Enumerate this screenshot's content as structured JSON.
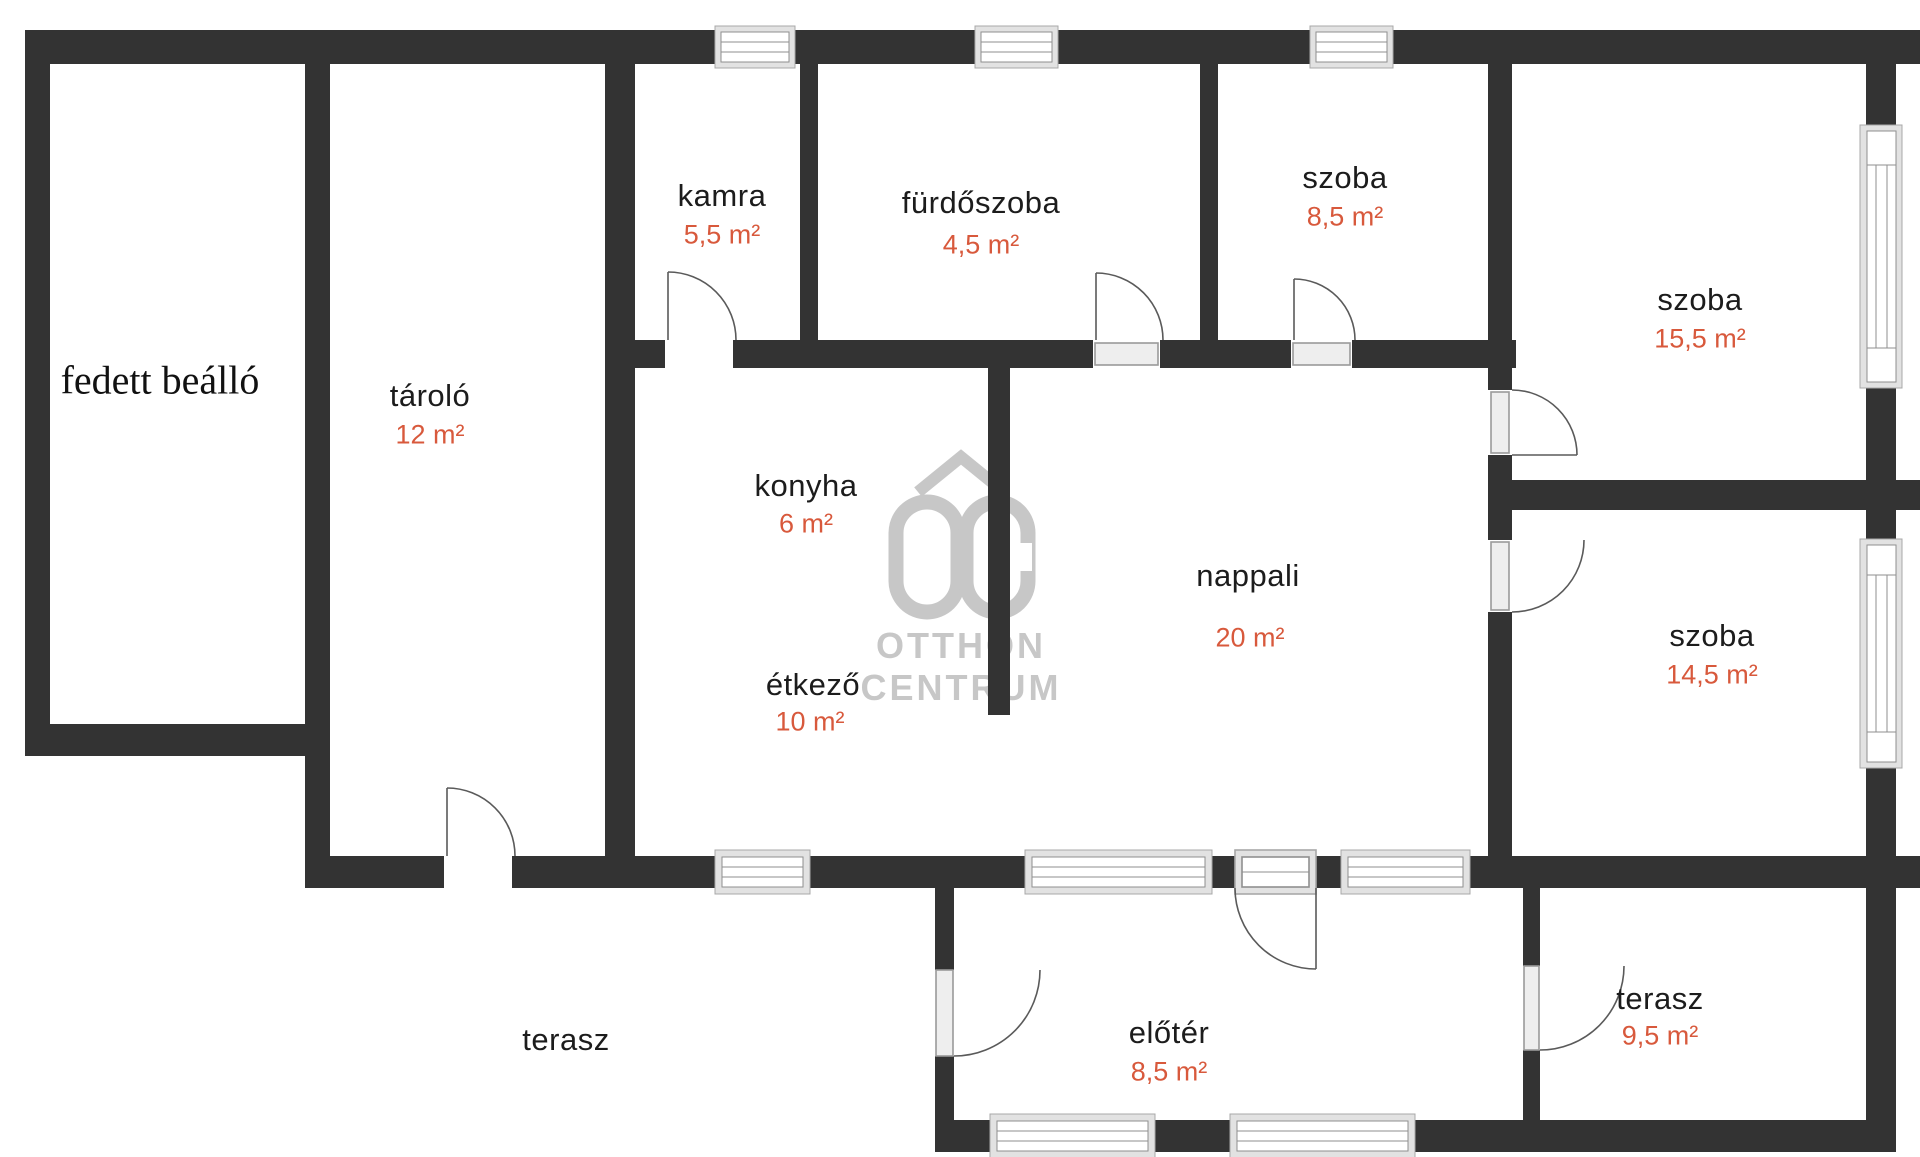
{
  "title": "floor-plan",
  "colors": {
    "wall": "#333333",
    "accent_area": "#d8593c",
    "room_text": "#1c1c1c",
    "watermark": "#c7c7c7",
    "window_frame": "#e2e2e2",
    "window_line": "#8f8f8f"
  },
  "watermark": {
    "monogram": "OC",
    "line1": "OTTHON",
    "line2": "CENTRUM"
  },
  "rooms": [
    {
      "id": "fedett-beallo",
      "name": "fedett beálló",
      "area": ""
    },
    {
      "id": "tarolo",
      "name": "tároló",
      "area": "12 m²"
    },
    {
      "id": "kamra",
      "name": "kamra",
      "area": "5,5 m²"
    },
    {
      "id": "furdoszoba",
      "name": "fürdőszoba",
      "area": "4,5 m²"
    },
    {
      "id": "szoba-felso",
      "name": "szoba",
      "area": "8,5 m²"
    },
    {
      "id": "szoba-jobb-felso",
      "name": "szoba",
      "area": "15,5 m²"
    },
    {
      "id": "konyha",
      "name": "konyha",
      "area": "6 m²"
    },
    {
      "id": "etkezo",
      "name": "étkező",
      "area": "10 m²"
    },
    {
      "id": "nappali",
      "name": "nappali",
      "area": "20 m²"
    },
    {
      "id": "szoba-jobb-also",
      "name": "szoba",
      "area": "14,5 m²"
    },
    {
      "id": "terasz-bal",
      "name": "terasz",
      "area": ""
    },
    {
      "id": "eloter",
      "name": "előtér",
      "area": "8,5 m²"
    },
    {
      "id": "terasz-jobb",
      "name": "terasz",
      "area": "9,5 m²"
    }
  ]
}
